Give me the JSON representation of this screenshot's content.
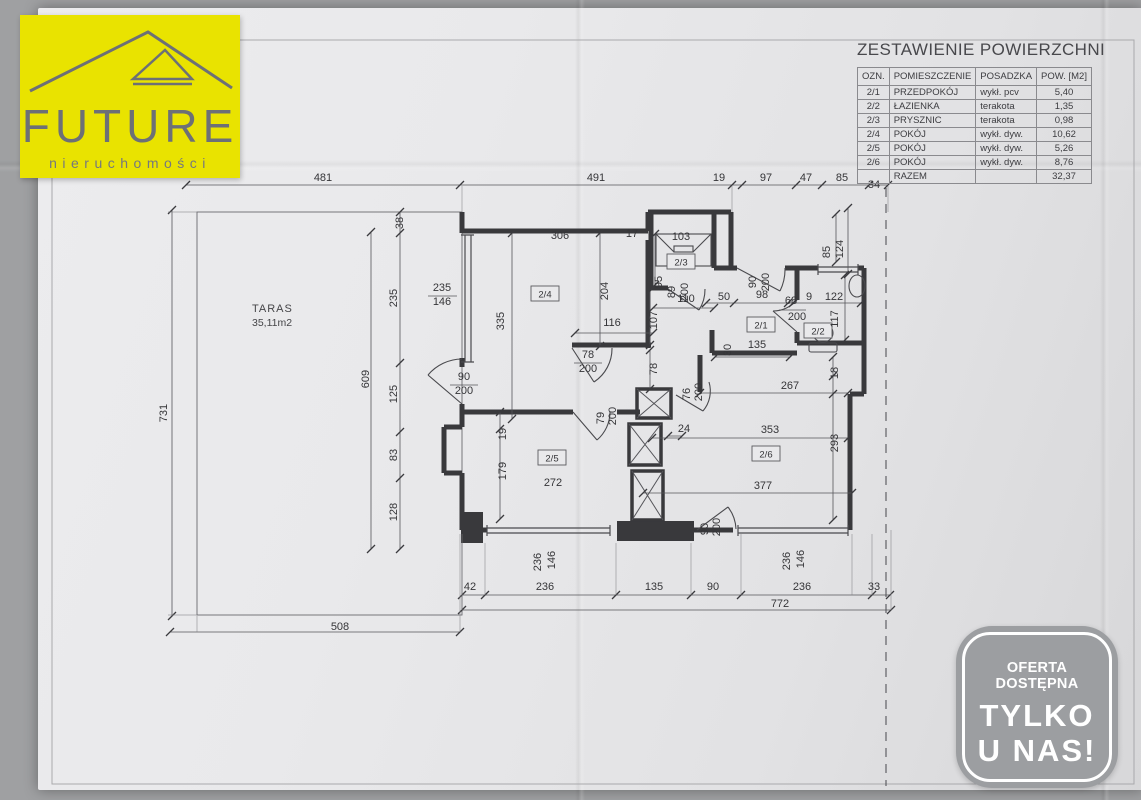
{
  "logo": {
    "name": "FUTURE",
    "subtitle": "nieruchomości",
    "bg_color": "#e9e300",
    "fg_color": "#6d7076"
  },
  "summary_table": {
    "title": "ZESTAWIENIE POWIERZCHNI",
    "headers": [
      "OZN.",
      "POMIESZCZENIE",
      "POSADZKA",
      "POW. [M2]"
    ],
    "rows": [
      [
        "2/1",
        "PRZEDPOKÓJ",
        "wykł. pcv",
        "5,40"
      ],
      [
        "2/2",
        "ŁAZIENKA",
        "terakota",
        "1,35"
      ],
      [
        "2/3",
        "PRYSZNIC",
        "terakota",
        "0,98"
      ],
      [
        "2/4",
        "POKÓJ",
        "wykł. dyw.",
        "10,62"
      ],
      [
        "2/5",
        "POKÓJ",
        "wykł. dyw.",
        "5,26"
      ],
      [
        "2/6",
        "POKÓJ",
        "wykł. dyw.",
        "8,76"
      ]
    ],
    "total_label": "RAZEM",
    "total_value": "32,37"
  },
  "badge": {
    "line1": "OFERTA DOSTĘPNA",
    "line2": "TYLKO",
    "line3": "U NAS!",
    "bg_color": "#9c9ea1",
    "fg_color": "#ffffff"
  },
  "plan": {
    "taras_label": "TARAS",
    "taras_area": "35,11m2",
    "room_tags": [
      {
        "t": "2/4",
        "x": 545,
        "y": 294
      },
      {
        "t": "2/3",
        "x": 681,
        "y": 262
      },
      {
        "t": "2/1",
        "x": 761,
        "y": 325
      },
      {
        "t": "2/2",
        "x": 818,
        "y": 331
      },
      {
        "t": "2/5",
        "x": 552,
        "y": 458
      },
      {
        "t": "2/6",
        "x": 766,
        "y": 454
      }
    ],
    "dims": [
      {
        "t": "481",
        "x": 323,
        "y": 181
      },
      {
        "t": "491",
        "x": 596,
        "y": 181
      },
      {
        "t": "19",
        "x": 719,
        "y": 181
      },
      {
        "t": "97",
        "x": 766,
        "y": 181
      },
      {
        "t": "47",
        "x": 806,
        "y": 181
      },
      {
        "t": "85",
        "x": 842,
        "y": 181
      },
      {
        "t": "34",
        "x": 874,
        "y": 188
      },
      {
        "t": "731",
        "x": 167,
        "y": 413,
        "r": 1
      },
      {
        "t": "38",
        "x": 403,
        "y": 223,
        "r": 1
      },
      {
        "t": "235",
        "x": 397,
        "y": 298,
        "r": 1
      },
      {
        "t": "125",
        "x": 397,
        "y": 394,
        "r": 1
      },
      {
        "t": "83",
        "x": 397,
        "y": 455,
        "r": 1
      },
      {
        "t": "128",
        "x": 397,
        "y": 512,
        "r": 1
      },
      {
        "t": "609",
        "x": 369,
        "y": 379,
        "r": 1
      },
      {
        "t": "235",
        "x": 442,
        "y": 291
      },
      {
        "t": "146",
        "x": 442,
        "y": 305
      },
      {
        "t": "306",
        "x": 560,
        "y": 239
      },
      {
        "t": "17",
        "x": 632,
        "y": 237
      },
      {
        "t": "103",
        "x": 681,
        "y": 240
      },
      {
        "t": "95",
        "x": 662,
        "y": 282,
        "r": 1
      },
      {
        "t": "335",
        "x": 504,
        "y": 321,
        "r": 1
      },
      {
        "t": "204",
        "x": 608,
        "y": 291,
        "r": 1
      },
      {
        "t": "116",
        "x": 612,
        "y": 326
      },
      {
        "t": "110",
        "x": 686,
        "y": 302
      },
      {
        "t": "107",
        "x": 657,
        "y": 320,
        "r": 1
      },
      {
        "t": "89",
        "x": 675,
        "y": 292,
        "r": 1
      },
      {
        "t": "200",
        "x": 688,
        "y": 292,
        "r": 1
      },
      {
        "t": "50",
        "x": 724,
        "y": 300
      },
      {
        "t": "90",
        "x": 756,
        "y": 282,
        "r": 1
      },
      {
        "t": "200",
        "x": 769,
        "y": 282,
        "r": 1
      },
      {
        "t": "98",
        "x": 762,
        "y": 298
      },
      {
        "t": "68",
        "x": 791,
        "y": 304
      },
      {
        "t": "200",
        "x": 797,
        "y": 320
      },
      {
        "t": "9",
        "x": 809,
        "y": 300
      },
      {
        "t": "122",
        "x": 834,
        "y": 300
      },
      {
        "t": "85",
        "x": 830,
        "y": 252,
        "r": 1
      },
      {
        "t": "124",
        "x": 843,
        "y": 249,
        "r": 1
      },
      {
        "t": "117",
        "x": 838,
        "y": 319,
        "r": 1
      },
      {
        "t": "135",
        "x": 757,
        "y": 348
      },
      {
        "t": "30",
        "x": 731,
        "y": 350,
        "r": 1
      },
      {
        "t": "267",
        "x": 790,
        "y": 389
      },
      {
        "t": "18",
        "x": 838,
        "y": 373,
        "r": 1
      },
      {
        "t": "353",
        "x": 770,
        "y": 433
      },
      {
        "t": "293",
        "x": 838,
        "y": 443,
        "r": 1
      },
      {
        "t": "377",
        "x": 763,
        "y": 489
      },
      {
        "t": "24",
        "x": 684,
        "y": 432
      },
      {
        "t": "78",
        "x": 588,
        "y": 358
      },
      {
        "t": "200",
        "x": 588,
        "y": 372
      },
      {
        "t": "79",
        "x": 604,
        "y": 418,
        "r": 1
      },
      {
        "t": "200",
        "x": 616,
        "y": 416,
        "r": 1
      },
      {
        "t": "76",
        "x": 690,
        "y": 394,
        "r": 1
      },
      {
        "t": "200",
        "x": 702,
        "y": 392,
        "r": 1
      },
      {
        "t": "78",
        "x": 657,
        "y": 369,
        "r": 1
      },
      {
        "t": "19",
        "x": 506,
        "y": 434,
        "r": 1
      },
      {
        "t": "179",
        "x": 506,
        "y": 471,
        "r": 1
      },
      {
        "t": "272",
        "x": 553,
        "y": 486
      },
      {
        "t": "90",
        "x": 464,
        "y": 380
      },
      {
        "t": "200",
        "x": 464,
        "y": 394
      },
      {
        "t": "236",
        "x": 541,
        "y": 562,
        "r": 1
      },
      {
        "t": "146",
        "x": 555,
        "y": 560,
        "r": 1
      },
      {
        "t": "236",
        "x": 790,
        "y": 561,
        "r": 1
      },
      {
        "t": "146",
        "x": 804,
        "y": 559,
        "r": 1
      },
      {
        "t": "90",
        "x": 708,
        "y": 529,
        "r": 1
      },
      {
        "t": "200",
        "x": 720,
        "y": 527,
        "r": 1
      },
      {
        "t": "42",
        "x": 470,
        "y": 590
      },
      {
        "t": "236",
        "x": 545,
        "y": 590
      },
      {
        "t": "135",
        "x": 654,
        "y": 590
      },
      {
        "t": "90",
        "x": 713,
        "y": 590
      },
      {
        "t": "236",
        "x": 802,
        "y": 590
      },
      {
        "t": "33",
        "x": 874,
        "y": 590
      },
      {
        "t": "772",
        "x": 780,
        "y": 607
      },
      {
        "t": "508",
        "x": 340,
        "y": 630
      }
    ]
  }
}
